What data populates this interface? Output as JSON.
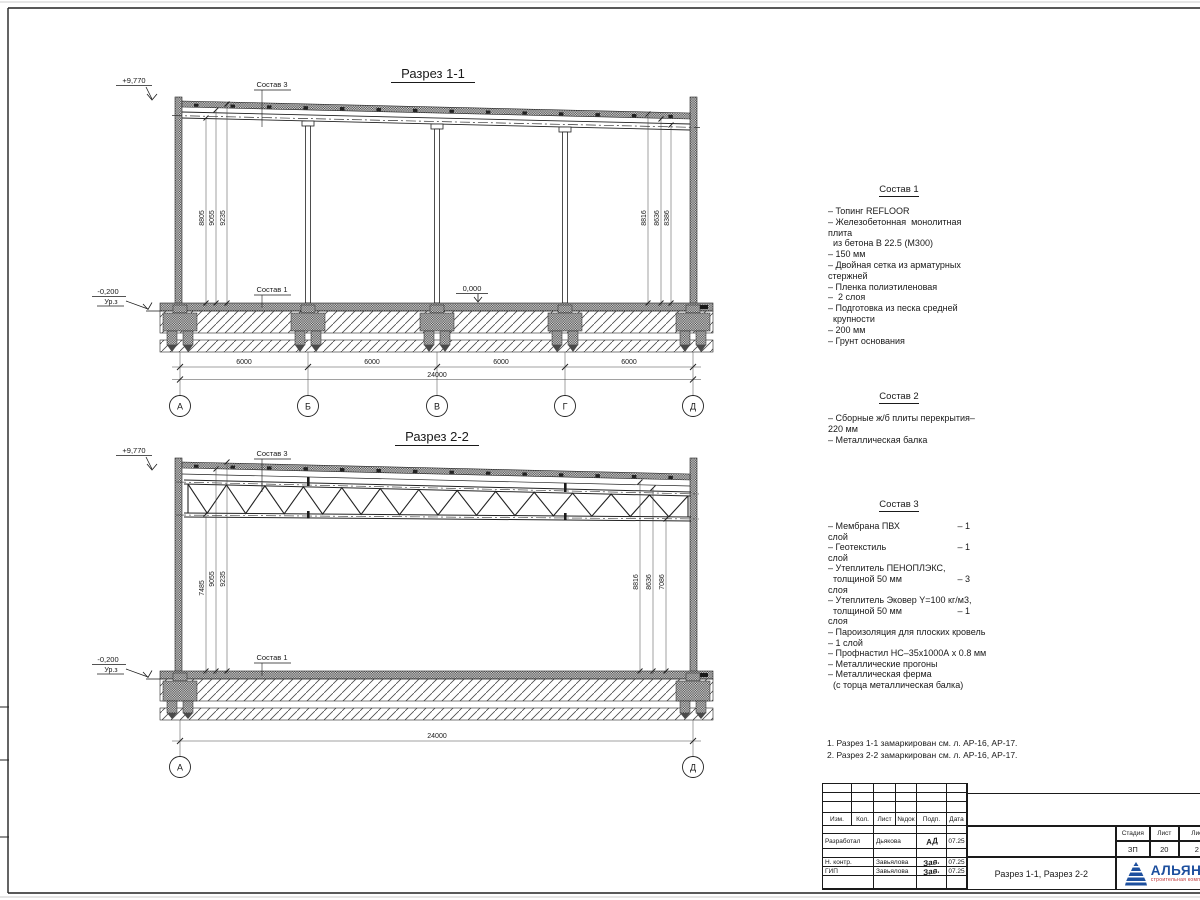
{
  "sections": {
    "s1": {
      "title": "Разрез 1-1",
      "elev_top": "+9,770",
      "elev_zero": "0,000",
      "elev_ground": "-0,200",
      "ground_label": "Ур.з",
      "callout_roof": "Состав 3",
      "callout_floor": "Состав 1",
      "dims_left": [
        "8805",
        "9055",
        "9235"
      ],
      "dims_right": [
        "8816",
        "8636",
        "8386"
      ],
      "dims_span": [
        "6000",
        "6000",
        "6000",
        "6000"
      ],
      "dim_total": "24000",
      "axes": [
        "А",
        "Б",
        "В",
        "Г",
        "Д"
      ]
    },
    "s2": {
      "title": "Разрез 2-2",
      "elev_top": "+9,770",
      "elev_ground": "-0,200",
      "ground_label": "Ур.з",
      "callout_roof": "Состав 3",
      "callout_floor": "Состав 1",
      "dims_left": [
        "7485",
        "9055",
        "9235"
      ],
      "dims_right": [
        "8816",
        "8636",
        "7086"
      ],
      "dim_total": "24000",
      "axes": [
        "А",
        "Д"
      ]
    }
  },
  "legend": {
    "sostav1": {
      "title": "Состав 1",
      "lines": [
        {
          "text": "– Топинг REFLOOR",
          "tail": ""
        },
        {
          "text": "– Железобетонная  монолитная",
          "tail": ""
        },
        {
          "text": "плита",
          "tail": ""
        },
        {
          "text": "  из бетона В 22.5 (М300)",
          "tail": ""
        },
        {
          "text": "– 150 мм",
          "tail": ""
        },
        {
          "text": "– Двойная сетка из арматурных",
          "tail": ""
        },
        {
          "text": "стержней",
          "tail": ""
        },
        {
          "text": "– Пленка полиэтиленовая",
          "tail": ""
        },
        {
          "text": "–  2 слоя",
          "tail": ""
        },
        {
          "text": "– Подготовка из песка средней",
          "tail": ""
        },
        {
          "text": "  крупности",
          "tail": ""
        },
        {
          "text": "– 200 мм",
          "tail": ""
        },
        {
          "text": "– Грунт основания",
          "tail": ""
        }
      ]
    },
    "sostav2": {
      "title": "Состав 2",
      "lines": [
        {
          "text": "– Сборные ж/б плиты перекрытия–",
          "tail": ""
        },
        {
          "text": "220 мм",
          "tail": ""
        },
        {
          "text": "– Металлическая балка",
          "tail": ""
        }
      ]
    },
    "sostav3": {
      "title": "Состав 3",
      "lines": [
        {
          "text": "– Мембрана ПВХ",
          "tail": "– 1"
        },
        {
          "text": "слой",
          "tail": ""
        },
        {
          "text": "– Геотекстиль",
          "tail": "– 1"
        },
        {
          "text": "слой",
          "tail": ""
        },
        {
          "text": "– Утеплитель ПЕНОПЛЭКС,",
          "tail": ""
        },
        {
          "text": "  толщиной 50 мм",
          "tail": "– 3"
        },
        {
          "text": "слоя",
          "tail": ""
        },
        {
          "text": "– Утеплитель Эковер Y=100 кг/м3,",
          "tail": ""
        },
        {
          "text": "  толщиной 50 мм",
          "tail": "– 1"
        },
        {
          "text": "слоя",
          "tail": ""
        },
        {
          "text": "– Пароизоляция для плоских кровель",
          "tail": ""
        },
        {
          "text": "– 1 слой",
          "tail": ""
        },
        {
          "text": "– Профнастил НС–35х1000А х 0.8 мм",
          "tail": ""
        },
        {
          "text": "– Металлические прогоны",
          "tail": ""
        },
        {
          "text": "– Металлическая ферма",
          "tail": ""
        },
        {
          "text": "  (с торца металлическая балка)",
          "tail": ""
        }
      ]
    }
  },
  "notes": {
    "n1": "1. Разрез 1-1 замаркирован см. л. АР-16, АР-17.",
    "n2": "2. Разрез 2-2 замаркирован см. л. АР-16, АР-17."
  },
  "stamp": {
    "header": [
      "Изм.",
      "Кол.",
      "Лист",
      "№док",
      "Подп.",
      "Дата"
    ],
    "rows": [
      {
        "role": "Разработал",
        "name": "Дьякова",
        "sig": "АД",
        "date": "07.25"
      },
      {
        "role": "Н. контр.",
        "name": "Завьялова",
        "sig": "Зав.",
        "date": "07.25"
      },
      {
        "role": "ГИП",
        "name": "Завьялова",
        "sig": "Зав.",
        "date": "07.25"
      }
    ],
    "stadia_labels": [
      "Стадия",
      "Лист",
      "Лис"
    ],
    "stadia_values": [
      "ЗП",
      "20",
      "2"
    ],
    "doc_title": "Разрез 1-1, Разрез 2-2",
    "logo_name": "АЛЬЯН",
    "logo_tagline": "строительная комп"
  },
  "colors": {
    "line": "#1a1a1a",
    "logo_blue": "#1d4f9e",
    "logo_red": "#c03030"
  }
}
